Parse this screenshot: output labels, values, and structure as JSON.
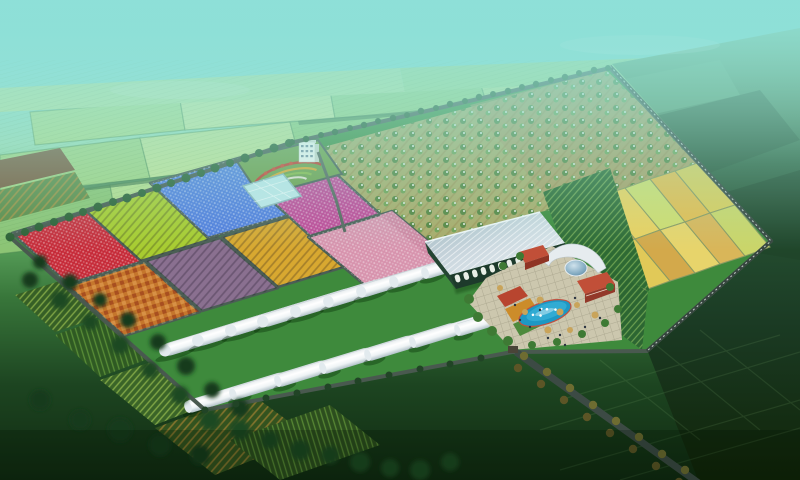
{
  "meta": {
    "kind": "aerial-architectural-rendering",
    "subject": "agricultural demonstration park master plan, bird's-eye view",
    "has_text": false
  },
  "palette": {
    "sky_haze": "#76d6d0",
    "haze_overlay": "#9ae3d8",
    "distant_field": "#a6d684",
    "outside_green": "#2c5a3a",
    "dark_field": "#142e15",
    "complex_grass": "#3e8a3c",
    "road": "#49594f",
    "wall": "#36453e",
    "plot_red": "#c62a38",
    "plot_chartreuse": "#a8cc30",
    "plot_blue": "#4f7cdc",
    "plot_orange": "#c5762c",
    "plot_mauve": "#8a7090",
    "plot_gold": "#d8a830",
    "plot_magenta": "#bf4796",
    "plot_pink": "#d793ad",
    "pond_cyan": "#bfe6e8",
    "garden_green": "#6f9e4a",
    "orchard_ground": "#a9ab69",
    "greenhouse_roof": "#c3d2da",
    "greenhouse_wall": "#1d3a2b",
    "tunnel_white": "#f4f7f9",
    "plaza_paving": "#ccc7ae",
    "pool_blue": "#1d98c4",
    "dome_blue": "#7fa8bf",
    "brick_red": "#c14f38",
    "wheat_cells": [
      "#d9b254",
      "#e9d160",
      "#cfdc6e",
      "#e3bd50",
      "#d9cc5b",
      "#e1c958",
      "#d3a94b",
      "#e7d46b",
      "#d9b659",
      "#cad569"
    ]
  },
  "scene": {
    "regions": [
      {
        "id": "sky-haze",
        "label": "teal atmospheric haze over horizon"
      },
      {
        "id": "distant-farmland",
        "label": "gridded green farmland fading into haze"
      },
      {
        "id": "outside-countryside",
        "label": "dark natural ground outside east boundary wall"
      },
      {
        "id": "flower-plots",
        "label": "grid of colored flower/crop plots",
        "colors": [
          "red",
          "chartreuse",
          "blue",
          "orange",
          "mauve",
          "gold",
          "magenta",
          "pink"
        ]
      },
      {
        "id": "ornamental-garden",
        "label": "curved terraced flower garden with small white office building"
      },
      {
        "id": "glass-pond",
        "label": "small cyan glass pond/greenhouse"
      },
      {
        "id": "orchard",
        "label": "blossoming fruit-tree orchard in rows"
      },
      {
        "id": "wheat-fields",
        "label": "golden grain plots, 2 rows x 5 cells"
      },
      {
        "id": "vegetable-rows",
        "label": "dark green row-crop strips beside conservatory"
      },
      {
        "id": "glass-conservatory",
        "label": "large glass exhibition greenhouse with arched bays"
      },
      {
        "id": "visitor-center",
        "label": "curved-roof building with blue dome and brick wings"
      },
      {
        "id": "plaza",
        "label": "paved plaza with kidney swimming pool, fountains, trees, people"
      },
      {
        "id": "tunnel-greenhouses",
        "label": "white plastic tunnel greenhouses",
        "count_back_row": 10,
        "count_front_row": 8
      },
      {
        "id": "entrance-road",
        "label": "tree-lined entrance road running southeast"
      },
      {
        "id": "boundary-wall",
        "label": "fenced boundary wall of the park"
      },
      {
        "id": "outside-crops",
        "label": "dark striped crop fields and tree masses outside southwest edge"
      }
    ]
  }
}
